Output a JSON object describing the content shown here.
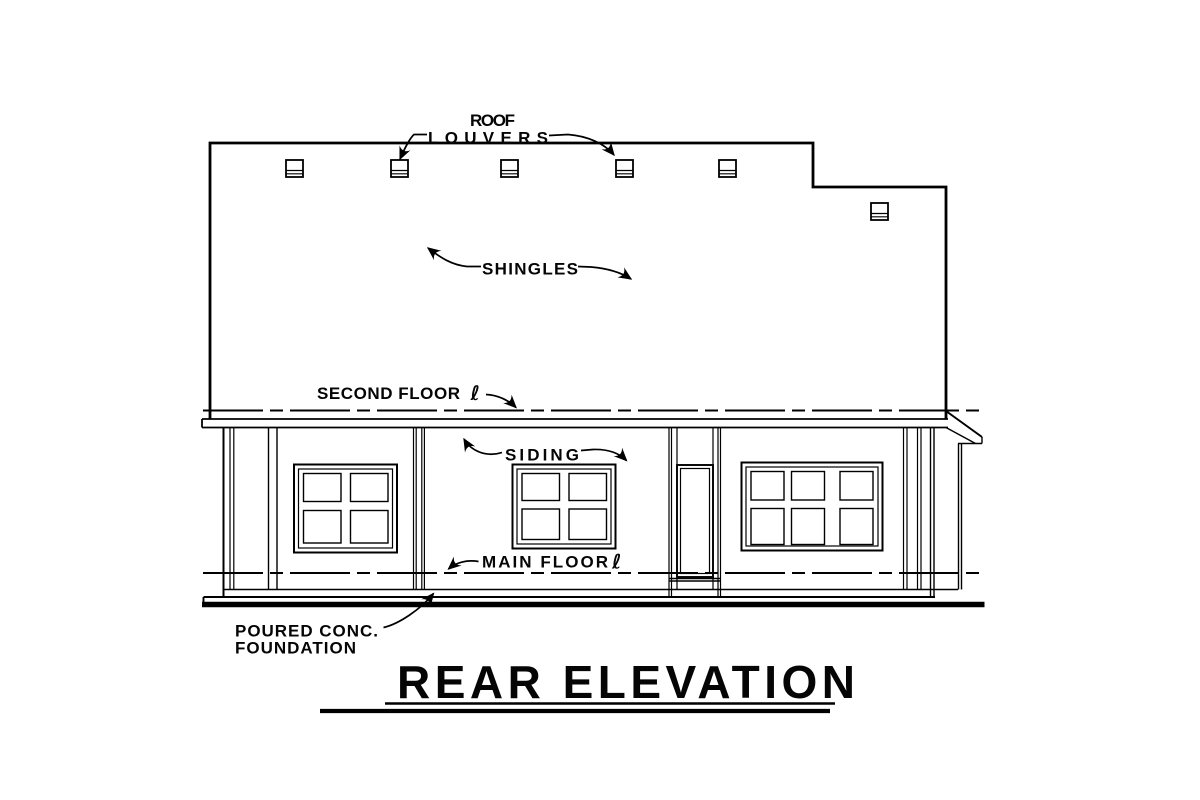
{
  "drawing": {
    "type": "architectural-elevation",
    "title": "REAR ELEVATION",
    "annotations": {
      "roof_louvers": {
        "line1": "ROOF",
        "line2": "LOUVERS"
      },
      "shingles": "SHINGLES",
      "second_floor": {
        "label": "SECOND FLOOR",
        "symbol": "ℓ"
      },
      "siding": "SIDING",
      "main_floor": {
        "label": "MAIN FLOOR",
        "symbol": "ℓ"
      },
      "foundation": {
        "line1": "POURED CONC.",
        "line2": "FOUNDATION"
      }
    },
    "colors": {
      "ink": "#000000",
      "paper": "#ffffff"
    }
  }
}
